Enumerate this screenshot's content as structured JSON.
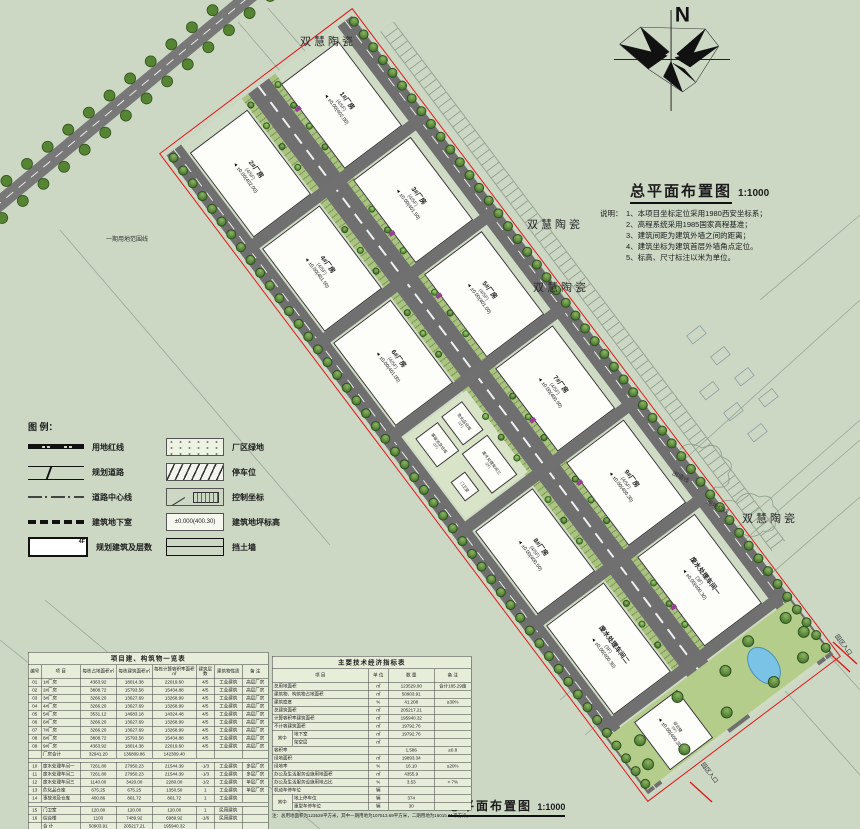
{
  "north": {
    "label": "N"
  },
  "title_block": {
    "title": "总平面布置图",
    "scale": "1:1000",
    "notes_label": "说明：",
    "notes": [
      "1、本项目坐标定位采用1980西安坐标系；",
      "2、高程系统采用1985国家高程基准；",
      "3、建筑间距为建筑外墙之间的距离；",
      "4、建筑坐标为建筑首层外墙角点定位。",
      "5、标高、尺寸标注以米为单位。"
    ]
  },
  "footer": {
    "title": "总平面布置图",
    "scale": "1:1000"
  },
  "context_labels": {
    "ceramics": "双慧陶瓷",
    "phase1_line": "一期用地范围线",
    "wall_line": "围墙线",
    "red_line": "用地红线",
    "entrance": "园区入口"
  },
  "legend": {
    "title": "图 例：",
    "left": [
      {
        "type": "redline",
        "label": "用地红线"
      },
      {
        "type": "road",
        "label": "规划道路"
      },
      {
        "type": "centerline",
        "label": "道路中心线"
      },
      {
        "type": "basement",
        "label": "建筑地下室"
      },
      {
        "type": "bldg",
        "label": "规划建筑及层数"
      }
    ],
    "right": [
      {
        "type": "green",
        "label": "厂区绿地"
      },
      {
        "type": "parking",
        "label": "停车位"
      },
      {
        "type": "coord",
        "label": "控制坐标"
      },
      {
        "type": "elev",
        "label": "建筑地坪标高",
        "sample": "±0.000(400.30)"
      },
      {
        "type": "retwall",
        "label": "挡土墙"
      }
    ]
  },
  "site": {
    "buildings": [
      {
        "name": "1#厂房",
        "sub": "4/5F",
        "elev": "±0.00(402.00)",
        "x": 12,
        "y": 26,
        "w": 104,
        "h": 70
      },
      {
        "name": "3#厂房",
        "sub": "4/5F",
        "elev": "±0.00(401.50)",
        "x": 132,
        "y": 26,
        "w": 102,
        "h": 70
      },
      {
        "name": "5#厂房",
        "sub": "4/5F",
        "elev": "±0.00(401.00)",
        "x": 250,
        "y": 26,
        "w": 102,
        "h": 70
      },
      {
        "name": "7#厂房",
        "sub": "4/5F",
        "elev": "±0.00(400.50)",
        "x": 368,
        "y": 26,
        "w": 102,
        "h": 70
      },
      {
        "name": "9#厂房",
        "sub": "4/5F",
        "elev": "±0.00(400.30)",
        "x": 486,
        "y": 26,
        "w": 102,
        "h": 70
      },
      {
        "name": "废水处理车间一",
        "sub": "3F",
        "elev": "±0.00(400.30)",
        "x": 604,
        "y": 26,
        "w": 110,
        "h": 70
      },
      {
        "name": "2#厂房",
        "sub": "4/5F",
        "elev": "±0.00(402.00)",
        "x": 12,
        "y": 140,
        "w": 104,
        "h": 70
      },
      {
        "name": "4#厂房",
        "sub": "4/5F",
        "elev": "±0.00(401.50)",
        "x": 132,
        "y": 140,
        "w": 102,
        "h": 70
      },
      {
        "name": "6#厂房",
        "sub": "4/5F",
        "elev": "±0.00(401.00)",
        "x": 250,
        "y": 140,
        "w": 102,
        "h": 70
      },
      {
        "name": "8#厂房",
        "sub": "4/5F",
        "elev": "±0.00(400.50)",
        "x": 486,
        "y": 140,
        "w": 102,
        "h": 70
      },
      {
        "name": "废水处理车间二",
        "sub": "3F",
        "elev": "±0.00(400.30)",
        "x": 604,
        "y": 140,
        "w": 110,
        "h": 70
      },
      {
        "name": "综合楼",
        "sub": "6F",
        "elev": "±0.00(400.30)",
        "x": 734,
        "y": 146,
        "w": 58,
        "h": 52,
        "small": true
      },
      {
        "name": "危化品仓库",
        "sub": "1F",
        "x": 374,
        "y": 144,
        "w": 34,
        "h": 24,
        "small": true
      },
      {
        "name": "废水处理车间三",
        "sub": "2F",
        "x": 416,
        "y": 144,
        "w": 48,
        "h": 30,
        "small": true
      },
      {
        "name": "事故池及仓库",
        "sub": "1F",
        "x": 376,
        "y": 176,
        "w": 34,
        "h": 26,
        "small": true
      },
      {
        "name": "门卫室",
        "x": 432,
        "y": 184,
        "w": 22,
        "h": 16,
        "small": true
      }
    ],
    "cross_roads": [
      118,
      236,
      354,
      472,
      590,
      716
    ]
  },
  "tables": {
    "left": {
      "title": "项目建、构筑物一览表",
      "headers": [
        "编号",
        "项 目",
        "每栋占地面积㎡",
        "每栋建筑面积㎡",
        "每栋计算容积率面积㎡",
        "建筑层数",
        "建筑物性质",
        "备 注"
      ],
      "rows": [
        [
          "01",
          "1#厂房",
          "4363.92",
          "18014.38",
          "22019.60",
          "4/5",
          "工业建筑",
          "高层厂房"
        ],
        [
          "02",
          "2#厂房",
          "3808.72",
          "15793.58",
          "15434.88",
          "4/5",
          "工业建筑",
          "高层厂房"
        ],
        [
          "03",
          "3#厂房",
          "3266.20",
          "13627.69",
          "13268.99",
          "4/5",
          "工业建筑",
          "高层厂房"
        ],
        [
          "04",
          "4#厂房",
          "3266.20",
          "13627.69",
          "13268.99",
          "4/5",
          "工业建筑",
          "高层厂房"
        ],
        [
          "05",
          "5#厂房",
          "3531.12",
          "14683.18",
          "14324.48",
          "4/5",
          "工业建筑",
          "高层厂房"
        ],
        [
          "06",
          "6#厂房",
          "3266.20",
          "13627.69",
          "13268.99",
          "4/5",
          "工业建筑",
          "高层厂房"
        ],
        [
          "07",
          "7#厂房",
          "3266.20",
          "13627.69",
          "13268.99",
          "4/5",
          "工业建筑",
          "高层厂房"
        ],
        [
          "08",
          "8#厂房",
          "3808.72",
          "15793.58",
          "15434.88",
          "4/5",
          "工业建筑",
          "高层厂房"
        ],
        [
          "09",
          "9#厂房",
          "4363.92",
          "18014.38",
          "22019.60",
          "4/5",
          "工业建筑",
          "高层厂房"
        ],
        [
          "",
          "厂房合计",
          "32941.20",
          "136809.86",
          "142309.40",
          "",
          "",
          ""
        ],
        [
          "SPACER",
          "",
          "",
          "",
          "",
          "",
          "",
          ""
        ],
        [
          "10",
          "废水处理车间一",
          "7261.80",
          "27950.23",
          "21544.39",
          "-1/3",
          "工业建筑",
          "多层厂房"
        ],
        [
          "11",
          "废水处理车间二",
          "7261.80",
          "27950.23",
          "21544.39",
          "-1/3",
          "工业建筑",
          "多层厂房"
        ],
        [
          "12",
          "废水处理车间三",
          "1140.00",
          "3420.00",
          "2280.00",
          "-1/2",
          "工业建筑",
          "单层厂房"
        ],
        [
          "13",
          "危化品仓库",
          "675.25",
          "675.25",
          "1350.50",
          "1",
          "工业建筑",
          "单层厂房"
        ],
        [
          "14",
          "事故池及仓库",
          "400.86",
          "801.72",
          "801.72",
          "1",
          "工业建筑",
          ""
        ],
        [
          "SPACER",
          "",
          "",
          "",
          "",
          "",
          "",
          ""
        ],
        [
          "15",
          "门卫室",
          "120.00",
          "120.00",
          "120.00",
          "1",
          "民用建筑",
          ""
        ],
        [
          "16",
          "综合楼",
          "1103",
          "7489.92",
          "6989.92",
          "-1/6",
          "民用建筑",
          ""
        ],
        [
          "",
          "合 计",
          "50903.91",
          "205217.21",
          "195940.32",
          "",
          "",
          ""
        ]
      ]
    },
    "right": {
      "title": "主要技术经济指标表",
      "headers": [
        "项 目",
        "单 位",
        "数 量",
        "备 注"
      ],
      "rows": [
        {
          "item": "总用地面积",
          "unit": "㎡",
          "qty": "123529.00",
          "remark": "合计185.29亩"
        },
        {
          "item": "建筑物、构筑物占地面积",
          "unit": "㎡",
          "qty": "50903.91",
          "remark": ""
        },
        {
          "item": "建筑密度",
          "unit": "%",
          "qty": "41.208",
          "remark": "≥30%"
        },
        {
          "item": "总建筑面积",
          "unit": "㎡",
          "qty": "205217.21",
          "remark": ""
        },
        {
          "item": "计算容积率建筑面积",
          "unit": "㎡",
          "qty": "195940.32",
          "remark": ""
        },
        {
          "item": "不计容建筑面积",
          "unit": "㎡",
          "qty": "19792.76",
          "remark": ""
        },
        {
          "group": "其中",
          "item": "地下室",
          "unit": "㎡",
          "qty": "19792.76",
          "remark": ""
        },
        {
          "group": "其中",
          "item": "架空层",
          "unit": "㎡",
          "qty": "",
          "remark": ""
        },
        {
          "item": "容积率",
          "unit": "",
          "qty": "1.586",
          "remark": "≥0.8"
        },
        {
          "item": "绿地面积",
          "unit": "㎡",
          "qty": "19893.34",
          "remark": ""
        },
        {
          "item": "绿地率",
          "unit": "%",
          "qty": "16.10",
          "remark": "≤20%"
        },
        {
          "item": "办公及生活服务设施用地面积",
          "unit": "㎡",
          "qty": "4355.9",
          "remark": ""
        },
        {
          "item": "办公及生活服务设施用地占比",
          "unit": "%",
          "qty": "3.53",
          "remark": "< 7%"
        },
        {
          "item": "机动车停车位",
          "unit": "辆",
          "qty": "",
          "remark": ""
        },
        {
          "group": "其中 ",
          "item": "地上停车位",
          "unit": "辆",
          "qty": "374",
          "remark": ""
        },
        {
          "group": "其中 ",
          "item": "重型车停车位",
          "unit": "辆",
          "qty": "30",
          "remark": ""
        }
      ],
      "note": "注：总用地面积为123529平方米，其中一期用地为107513.69平方米，二期用地为16015.31平方米。"
    }
  }
}
